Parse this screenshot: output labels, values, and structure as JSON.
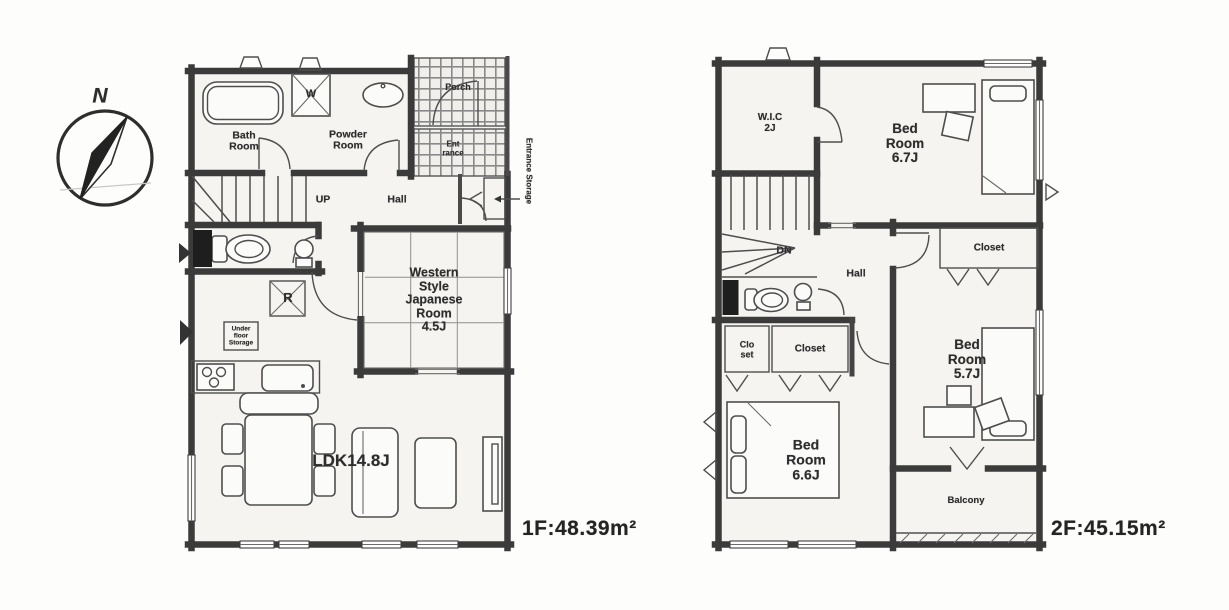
{
  "compass": {
    "north_label": "N"
  },
  "floor1": {
    "area_label": "1F:48.39m²",
    "rooms": {
      "bath": "Bath\nRoom",
      "powder": "Powder\nRoom",
      "washer": "W",
      "porch": "Porch",
      "entrance": "Ent\nrance",
      "entrance_storage": "Entrance Storage",
      "up": "UP",
      "hall": "Hall",
      "western_room": "Western\nStyle\nJapanese\nRoom\n4.5J",
      "refrigerator": "R",
      "underfloor_storage": "Under\nfloor\nStorage",
      "ldk": "LDK14.8J"
    }
  },
  "floor2": {
    "area_label": "2F:45.15m²",
    "rooms": {
      "wic": "W.I.C\n2J",
      "bedroom_67": "Bed\nRoom\n6.7J",
      "closet_top": "Closet",
      "dn": "DN",
      "hall": "Hall",
      "closet_small": "Clo\nset",
      "closet_mid": "Closet",
      "bedroom_57": "Bed\nRoom\n5.7J",
      "bedroom_66": "Bed\nRoom\n6.6J",
      "balcony": "Balcony"
    }
  },
  "colors": {
    "wall": "#3b3b3b",
    "room_fill": "#f5f4f1",
    "tile_line": "#8a8a8a",
    "text": "#2d2d2d",
    "paper": "#fdfdfc"
  }
}
